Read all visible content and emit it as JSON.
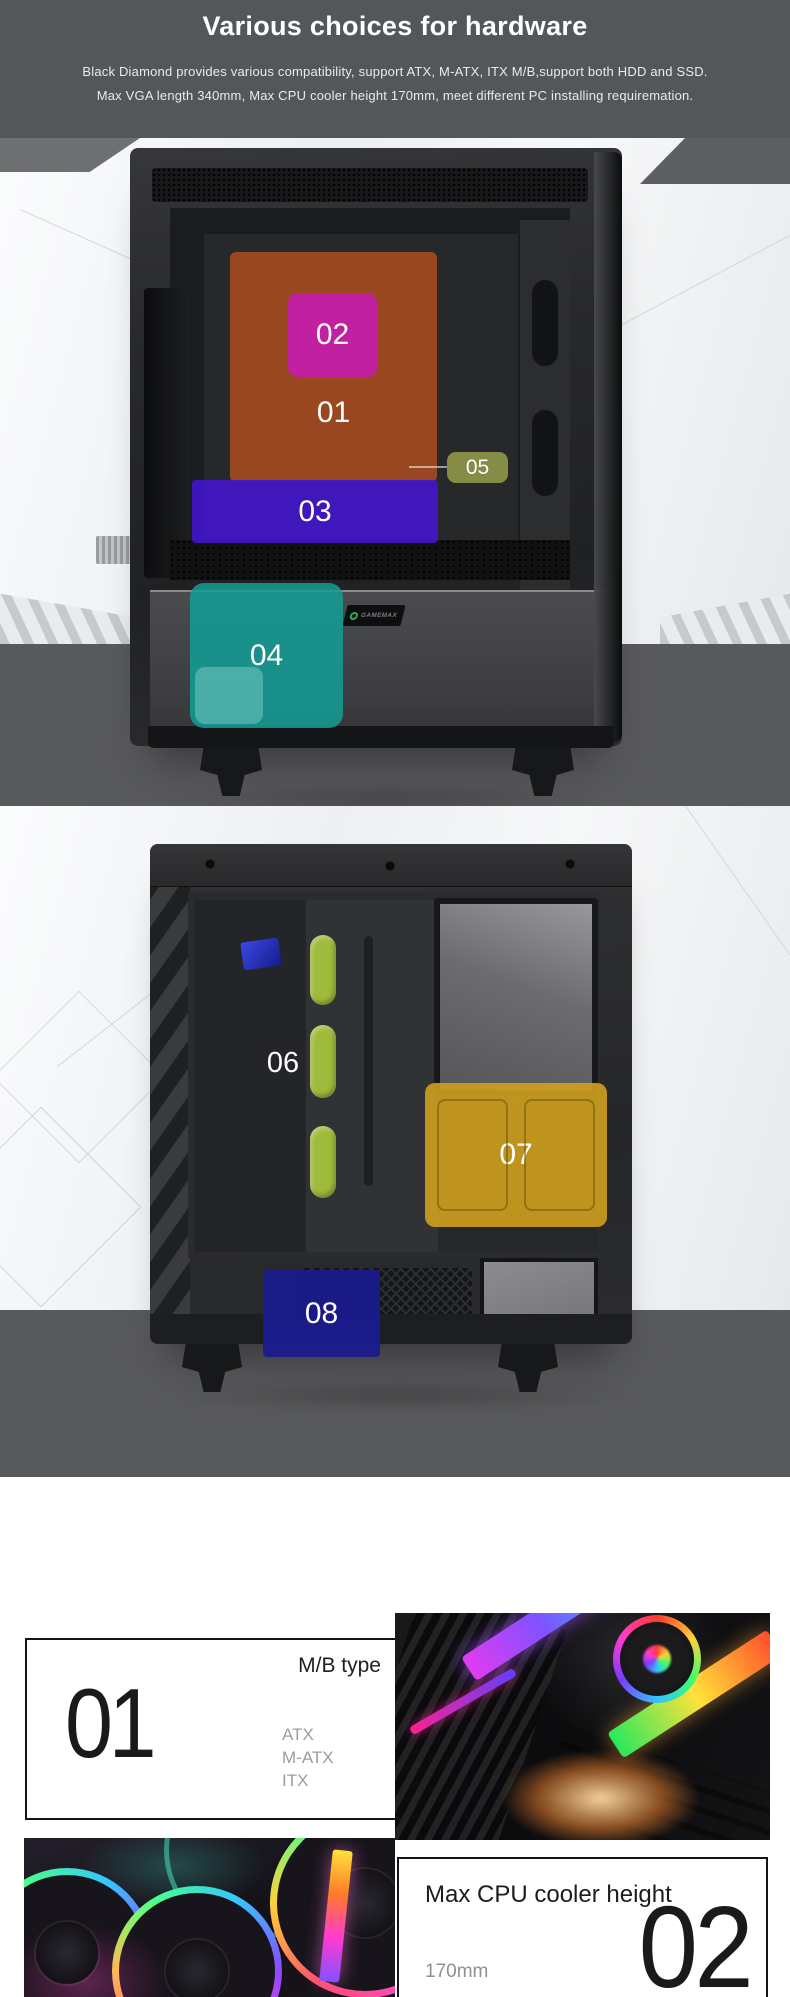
{
  "header": {
    "title": "Various choices for hardware",
    "subtitle_line1": "Black Diamond provides various compatibility, support ATX, M-ATX, ITX M/B,support both HDD and SSD.",
    "subtitle_line2": "Max VGA length 340mm, Max CPU cooler height 170mm, meet different PC installing requiremation."
  },
  "brand": {
    "logo_text": "GAMEMAX"
  },
  "front_view": {
    "callouts": [
      {
        "label": "01",
        "color": "#B34F1FD0"
      },
      {
        "label": "02",
        "color": "#C31FA8F0"
      },
      {
        "label": "03",
        "color": "#4315CEE0"
      },
      {
        "label": "04",
        "color": "#129E96D8"
      },
      {
        "label": "05",
        "color": "#8B9449EE"
      }
    ]
  },
  "rear_view": {
    "callouts": [
      {
        "label": "06",
        "color": "#A6C33CF0"
      },
      {
        "label": "07",
        "color": "#CFA01EE6"
      },
      {
        "label": "08",
        "color": "#1B1B8EF0"
      }
    ]
  },
  "cards": {
    "mb_type": {
      "number": "01",
      "title": "M/B type",
      "options": [
        "ATX",
        "M-ATX",
        "ITX"
      ]
    },
    "cpu_cooler": {
      "number": "02",
      "title": "Max CPU cooler height",
      "value": "170mm"
    }
  },
  "colors": {
    "header_bg": "#54575A",
    "stage_band": "#58595B"
  }
}
